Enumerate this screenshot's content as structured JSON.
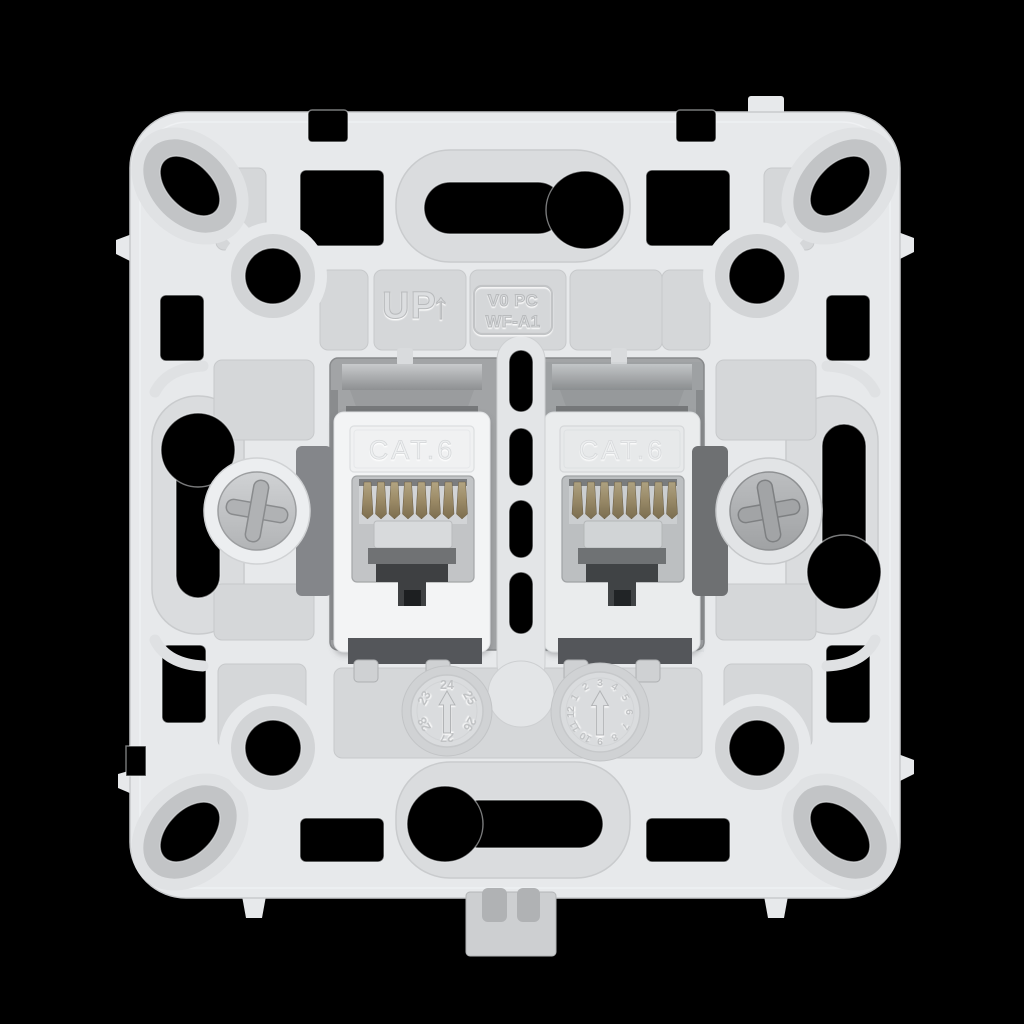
{
  "product": {
    "orientation_label": "UP",
    "orientation_arrow": "↑",
    "material_code_line1": "V0 PC",
    "material_code_line2": "WF-A1"
  },
  "ports": {
    "left_label": "CAT.6",
    "right_label": "CAT.6"
  },
  "date_wheels": {
    "year": {
      "numbers": [
        "23",
        "24",
        "25",
        "26",
        "27",
        "28"
      ]
    },
    "month": {
      "numbers": [
        "1",
        "2",
        "3",
        "4",
        "5",
        "6",
        "7",
        "8",
        "9",
        "10",
        "11",
        "12"
      ]
    }
  },
  "colors": {
    "background": "#000000",
    "plastic-light": "#e7e9eb",
    "plastic-panel": "#d5d7d9",
    "plastic-capsule": "#dadcde",
    "jack-face": "#f3f4f5",
    "module-gray": "#a2a4a6",
    "screw-head": "#c3c5c7",
    "claw-dark": "#84868a",
    "pin-gold": "#9b8a66",
    "hole": "#000000"
  }
}
